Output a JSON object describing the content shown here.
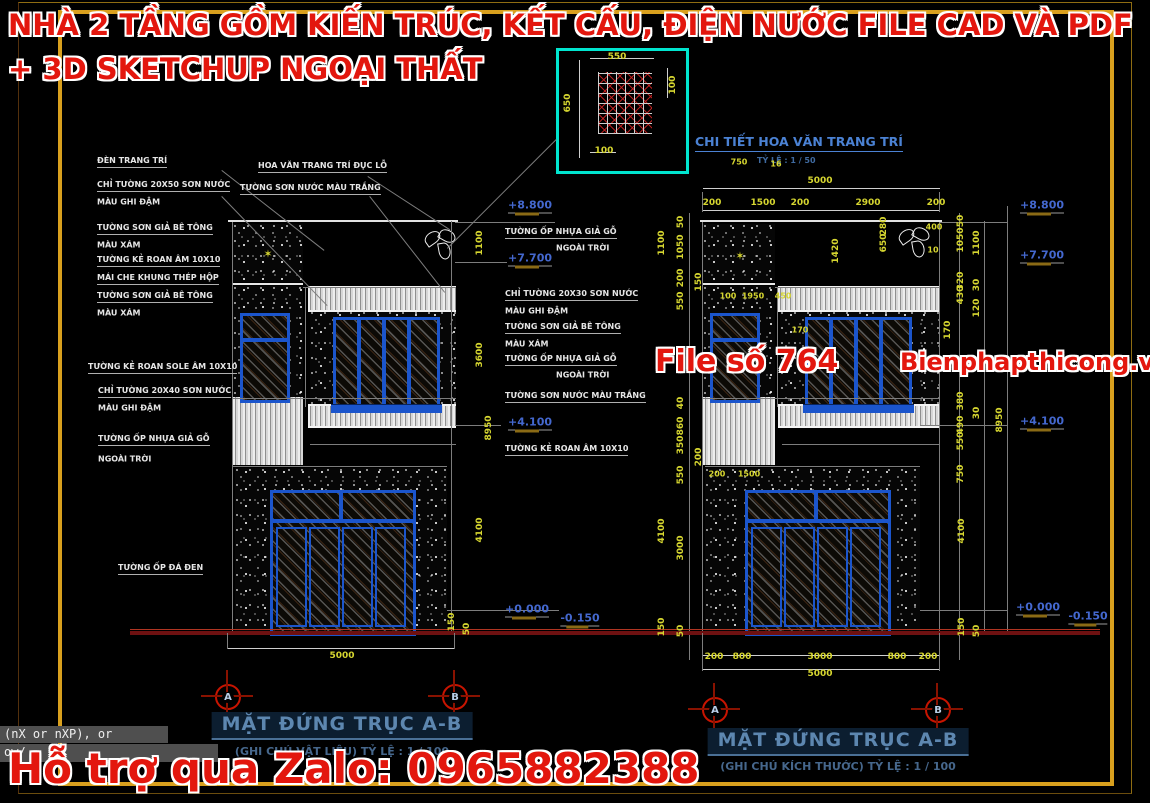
{
  "watermarks": {
    "top_line1": "NHÀ 2 TẦNG GỒM KIẾN TRÚC, KẾT CẤU, ĐIỆN NƯỚC FILE CAD VÀ PDF",
    "top_line2": "+ 3D SKETCHUP NGOẠI THẤT",
    "file_no": "File số 764",
    "site": "Bienphapthicong.vn",
    "bottom": "Hỗ trợ qua Zalo: 0965882388",
    "color": "#e3170e"
  },
  "detail_box": {
    "title": "CHI TIẾT HOA VĂN TRANG TRÍ",
    "scale": "TỶ LỆ : 1 / 50",
    "border_color": "#00e5cf"
  },
  "left_elevation": {
    "title": "MẶT ĐỨNG TRỤC A-B",
    "subtitle": "(GHI CHÚ VẬT LIỆU) TỶ LỆ : 1 / 100",
    "grid_axes": [
      "A",
      "B"
    ],
    "bottom_total_dim": "5000"
  },
  "right_elevation": {
    "title": "MẶT ĐỨNG TRỤC A-B",
    "subtitle": "(GHI CHÚ KÍCH THƯỚC) TỶ LỆ : 1 / 100",
    "grid_axes": [
      "A",
      "B"
    ],
    "top_total_dim": "5000",
    "top_chain_dims": [
      "200",
      "1500",
      "200",
      "2900",
      "200"
    ],
    "bottom_chain_dims": [
      "200",
      "800",
      "3000",
      "800",
      "200"
    ],
    "bottom_total_dim": "5000"
  },
  "levels": [
    "+8.800",
    "+7.700",
    "+4.100",
    "+0.000",
    "-0.150"
  ],
  "command_line": {
    "line1": "(nX or nXP), or",
    "line2": "ow/"
  },
  "colors": {
    "frame_orange": "#d9a01e",
    "dim_yellow": "#d6d630",
    "level_blue": "#4468cf",
    "cad_blue": "#1b55cc",
    "detail_cyan": "#00e5cf",
    "grid_bubble_red": "#c81400",
    "ground_red": "#6e1111",
    "title_blue": "#5d87b0",
    "watermark_red": "#e3170e"
  },
  "grid_bubbles": [
    {
      "letter": "A",
      "x": 228,
      "y": 697
    },
    {
      "letter": "B",
      "x": 455,
      "y": 697
    },
    {
      "letter": "A",
      "x": 715,
      "y": 710
    },
    {
      "letter": "B",
      "x": 938,
      "y": 710
    }
  ],
  "annotations": [
    {
      "t": "ĐÈN TRANG TRÍ",
      "x": 97,
      "y": 162,
      "c": "lblu"
    },
    {
      "t": "CHỈ TƯỜNG 20X50 SƠN NƯỚC",
      "x": 97,
      "y": 186,
      "c": "lblu"
    },
    {
      "t": "MÀU GHI ĐẬM",
      "x": 97,
      "y": 202,
      "c": "lbl"
    },
    {
      "t": "TƯỜNG SƠN GIẢ BÊ TÔNG",
      "x": 97,
      "y": 229,
      "c": "lblu"
    },
    {
      "t": "MÀU XÁM",
      "x": 97,
      "y": 245,
      "c": "lbl"
    },
    {
      "t": "TƯỜNG KẺ ROAN ÂM 10X10",
      "x": 97,
      "y": 261,
      "c": "lblu"
    },
    {
      "t": "MÁI CHE KHUNG THÉP HỘP",
      "x": 97,
      "y": 279,
      "c": "lblu"
    },
    {
      "t": "TƯỜNG SƠN GIẢ BÊ TÔNG",
      "x": 97,
      "y": 297,
      "c": "lblu"
    },
    {
      "t": "MÀU XÁM",
      "x": 97,
      "y": 313,
      "c": "lbl"
    },
    {
      "t": "TƯỜNG KẺ ROAN SOLE ÂM 10X10",
      "x": 88,
      "y": 368,
      "c": "lblu"
    },
    {
      "t": "CHỈ TƯỜNG 20X40 SƠN NƯỚC",
      "x": 98,
      "y": 392,
      "c": "lblu"
    },
    {
      "t": "MÀU GHI ĐẬM",
      "x": 98,
      "y": 408,
      "c": "lbl"
    },
    {
      "t": "TƯỜNG ỐP NHỰA GIẢ GỖ",
      "x": 98,
      "y": 440,
      "c": "lblu"
    },
    {
      "t": "NGOÀI TRỜI",
      "x": 98,
      "y": 459,
      "c": "lbl"
    },
    {
      "t": "TƯỜNG ỐP ĐÁ ĐEN",
      "x": 118,
      "y": 569,
      "c": "lblu"
    },
    {
      "t": "HOA VĂN TRANG TRÍ ĐỤC LỖ",
      "x": 258,
      "y": 167,
      "c": "lblu"
    },
    {
      "t": "TƯỜNG SƠN NƯỚC MÀU TRẮNG",
      "x": 240,
      "y": 189,
      "c": "lblu"
    },
    {
      "t": "TƯỜNG ỐP NHỰA GIẢ GỖ",
      "x": 505,
      "y": 233,
      "c": "lblu"
    },
    {
      "t": "NGOÀI TRỜI",
      "x": 556,
      "y": 248,
      "c": "lbl"
    },
    {
      "t": "CHỈ TƯỜNG 20X30 SƠN NƯỚC",
      "x": 505,
      "y": 295,
      "c": "lblu"
    },
    {
      "t": "MÀU GHI ĐẬM",
      "x": 505,
      "y": 311,
      "c": "lbl"
    },
    {
      "t": "TƯỜNG SƠN GIẢ BÊ TÔNG",
      "x": 505,
      "y": 328,
      "c": "lblu"
    },
    {
      "t": "MÀU XÁM",
      "x": 505,
      "y": 344,
      "c": "lbl"
    },
    {
      "t": "TƯỜNG ỐP NHỰA GIẢ GỖ",
      "x": 505,
      "y": 360,
      "c": "lblu"
    },
    {
      "t": "NGOÀI TRỜI",
      "x": 556,
      "y": 375,
      "c": "lbl"
    },
    {
      "t": "TƯỜNG SƠN NƯỚC MÀU TRẮNG",
      "x": 505,
      "y": 397,
      "c": "lblu"
    },
    {
      "t": "TƯỜNG KẺ ROAN ÂM 10X10",
      "x": 505,
      "y": 450,
      "c": "lblu"
    },
    {
      "t": "+8.800",
      "x": 530,
      "y": 206,
      "c": "lvl"
    },
    {
      "t": "+7.700",
      "x": 530,
      "y": 259,
      "c": "lvl"
    },
    {
      "t": "+4.100",
      "x": 530,
      "y": 423,
      "c": "lvl"
    },
    {
      "t": "+0.000",
      "x": 527,
      "y": 610,
      "c": "lvl"
    },
    {
      "t": "-0.150",
      "x": 580,
      "y": 619,
      "c": "lvl"
    },
    {
      "t": "+8.800",
      "x": 1042,
      "y": 206,
      "c": "lvl"
    },
    {
      "t": "+7.700",
      "x": 1042,
      "y": 256,
      "c": "lvl"
    },
    {
      "t": "+4.100",
      "x": 1042,
      "y": 422,
      "c": "lvl"
    },
    {
      "t": "+0.000",
      "x": 1038,
      "y": 608,
      "c": "lvl"
    },
    {
      "t": "-0.150",
      "x": 1088,
      "y": 617,
      "c": "lvl"
    },
    {
      "t": "1100",
      "x": 480,
      "y": 243,
      "c": "dimv"
    },
    {
      "t": "3600",
      "x": 480,
      "y": 355,
      "c": "dimv"
    },
    {
      "t": "8950",
      "x": 489,
      "y": 428,
      "c": "dimv"
    },
    {
      "t": "4100",
      "x": 480,
      "y": 530,
      "c": "dimv"
    },
    {
      "t": "150",
      "x": 452,
      "y": 622,
      "c": "dimv"
    },
    {
      "t": "50",
      "x": 467,
      "y": 629,
      "c": "dimv"
    },
    {
      "t": "5000",
      "x": 342,
      "y": 656,
      "c": "dim"
    },
    {
      "t": "550",
      "x": 617,
      "y": 57,
      "c": "dim"
    },
    {
      "t": "650",
      "x": 568,
      "y": 103,
      "c": "dimv"
    },
    {
      "t": "100",
      "x": 673,
      "y": 85,
      "c": "dimv"
    },
    {
      "t": "100",
      "x": 604,
      "y": 151,
      "c": "dim"
    },
    {
      "t": "5000",
      "x": 820,
      "y": 181,
      "c": "dim"
    },
    {
      "t": "200",
      "x": 712,
      "y": 203,
      "c": "dim"
    },
    {
      "t": "1500",
      "x": 763,
      "y": 203,
      "c": "dim"
    },
    {
      "t": "200",
      "x": 800,
      "y": 203,
      "c": "dim"
    },
    {
      "t": "2900",
      "x": 868,
      "y": 203,
      "c": "dim"
    },
    {
      "t": "200",
      "x": 936,
      "y": 203,
      "c": "dim"
    },
    {
      "t": "50",
      "x": 681,
      "y": 222,
      "c": "dimv"
    },
    {
      "t": "1050",
      "x": 681,
      "y": 247,
      "c": "dimv"
    },
    {
      "t": "1100",
      "x": 662,
      "y": 243,
      "c": "dimv"
    },
    {
      "t": "200",
      "x": 681,
      "y": 278,
      "c": "dimv"
    },
    {
      "t": "150",
      "x": 699,
      "y": 282,
      "c": "dimv"
    },
    {
      "t": "550",
      "x": 681,
      "y": 301,
      "c": "dimv"
    },
    {
      "t": "40",
      "x": 681,
      "y": 403,
      "c": "dimv"
    },
    {
      "t": "860",
      "x": 681,
      "y": 426,
      "c": "dimv"
    },
    {
      "t": "350",
      "x": 681,
      "y": 445,
      "c": "dimv"
    },
    {
      "t": "200",
      "x": 699,
      "y": 457,
      "c": "dimv"
    },
    {
      "t": "550",
      "x": 681,
      "y": 475,
      "c": "dimv"
    },
    {
      "t": "4100",
      "x": 662,
      "y": 531,
      "c": "dimv"
    },
    {
      "t": "3000",
      "x": 681,
      "y": 548,
      "c": "dimv"
    },
    {
      "t": "150",
      "x": 662,
      "y": 627,
      "c": "dimv"
    },
    {
      "t": "50",
      "x": 681,
      "y": 631,
      "c": "dimv"
    },
    {
      "t": "750",
      "x": 739,
      "y": 162,
      "c": "dims"
    },
    {
      "t": "16",
      "x": 776,
      "y": 164,
      "c": "dims"
    },
    {
      "t": "100",
      "x": 728,
      "y": 296,
      "c": "dims"
    },
    {
      "t": "1950",
      "x": 753,
      "y": 296,
      "c": "dims"
    },
    {
      "t": "450",
      "x": 783,
      "y": 296,
      "c": "dims"
    },
    {
      "t": "170",
      "x": 800,
      "y": 330,
      "c": "dims"
    },
    {
      "t": "1420",
      "x": 836,
      "y": 251,
      "c": "dimv"
    },
    {
      "t": "650",
      "x": 884,
      "y": 243,
      "c": "dimv"
    },
    {
      "t": "280",
      "x": 884,
      "y": 226,
      "c": "dimv"
    },
    {
      "t": "400",
      "x": 934,
      "y": 227,
      "c": "dims"
    },
    {
      "t": "10",
      "x": 933,
      "y": 250,
      "c": "dims"
    },
    {
      "t": "200",
      "x": 717,
      "y": 474,
      "c": "dims"
    },
    {
      "t": "1500",
      "x": 749,
      "y": 474,
      "c": "dims"
    },
    {
      "t": "50",
      "x": 961,
      "y": 221,
      "c": "dimv"
    },
    {
      "t": "1050",
      "x": 961,
      "y": 240,
      "c": "dimv"
    },
    {
      "t": "1100",
      "x": 977,
      "y": 243,
      "c": "dimv"
    },
    {
      "t": "320",
      "x": 961,
      "y": 281,
      "c": "dimv"
    },
    {
      "t": "430",
      "x": 961,
      "y": 295,
      "c": "dimv"
    },
    {
      "t": "30",
      "x": 977,
      "y": 285,
      "c": "dimv"
    },
    {
      "t": "120",
      "x": 977,
      "y": 308,
      "c": "dimv"
    },
    {
      "t": "170",
      "x": 948,
      "y": 330,
      "c": "dimv"
    },
    {
      "t": "380",
      "x": 961,
      "y": 401,
      "c": "dimv"
    },
    {
      "t": "30",
      "x": 977,
      "y": 413,
      "c": "dimv"
    },
    {
      "t": "490",
      "x": 961,
      "y": 425,
      "c": "dimv"
    },
    {
      "t": "8950",
      "x": 1000,
      "y": 420,
      "c": "dimv"
    },
    {
      "t": "550",
      "x": 961,
      "y": 441,
      "c": "dimv"
    },
    {
      "t": "750",
      "x": 961,
      "y": 474,
      "c": "dimv"
    },
    {
      "t": "4100",
      "x": 962,
      "y": 531,
      "c": "dimv"
    },
    {
      "t": "150",
      "x": 962,
      "y": 627,
      "c": "dimv"
    },
    {
      "t": "50",
      "x": 977,
      "y": 631,
      "c": "dimv"
    },
    {
      "t": "200",
      "x": 714,
      "y": 657,
      "c": "dim"
    },
    {
      "t": "800",
      "x": 742,
      "y": 657,
      "c": "dim"
    },
    {
      "t": "3000",
      "x": 820,
      "y": 657,
      "c": "dim"
    },
    {
      "t": "800",
      "x": 897,
      "y": 657,
      "c": "dim"
    },
    {
      "t": "200",
      "x": 928,
      "y": 657,
      "c": "dim"
    },
    {
      "t": "5000",
      "x": 820,
      "y": 674,
      "c": "dim"
    },
    {
      "t": "✶",
      "x": 268,
      "y": 254,
      "c": "dec"
    },
    {
      "t": "✶",
      "x": 740,
      "y": 256,
      "c": "dec"
    }
  ],
  "lines": [
    {
      "x": 228,
      "y": 220,
      "len": 230,
      "ang": 0,
      "col": "w"
    },
    {
      "x": 700,
      "y": 220,
      "len": 242,
      "ang": 0,
      "col": "w"
    },
    {
      "x": 228,
      "y": 648,
      "len": 227,
      "ang": 0,
      "col": "d"
    },
    {
      "x": 703,
      "y": 655,
      "len": 237,
      "ang": 0,
      "col": "d"
    },
    {
      "x": 703,
      "y": 669,
      "len": 237,
      "ang": 0,
      "col": "d"
    },
    {
      "x": 703,
      "y": 188,
      "len": 237,
      "ang": 0,
      "col": "d"
    },
    {
      "x": 703,
      "y": 210,
      "len": 237,
      "ang": 0,
      "col": "d"
    },
    {
      "x": 452,
      "y": 221,
      "len": 411,
      "ang": 90,
      "col": "g"
    },
    {
      "x": 690,
      "y": 213,
      "len": 447,
      "ang": 90,
      "col": "g"
    },
    {
      "x": 960,
      "y": 213,
      "len": 447,
      "ang": 90,
      "col": "g"
    },
    {
      "x": 985,
      "y": 221,
      "len": 411,
      "ang": 90,
      "col": "g"
    },
    {
      "x": 1008,
      "y": 206,
      "len": 426,
      "ang": 90,
      "col": "g"
    },
    {
      "x": 233,
      "y": 222,
      "len": 410,
      "ang": 90,
      "col": "g"
    },
    {
      "x": 703,
      "y": 222,
      "len": 410,
      "ang": 90,
      "col": "g"
    },
    {
      "x": 940,
      "y": 222,
      "len": 410,
      "ang": 90,
      "col": "g"
    },
    {
      "x": 306,
      "y": 287,
      "len": 120,
      "ang": 90,
      "col": "g"
    },
    {
      "x": 778,
      "y": 287,
      "len": 120,
      "ang": 90,
      "col": "g"
    },
    {
      "x": 303,
      "y": 287,
      "len": 153,
      "ang": 0,
      "col": "g"
    },
    {
      "x": 233,
      "y": 398,
      "len": 223,
      "ang": 0,
      "col": "g"
    },
    {
      "x": 310,
      "y": 444,
      "len": 146,
      "ang": 0,
      "col": "g"
    },
    {
      "x": 233,
      "y": 466,
      "len": 214,
      "ang": 0,
      "col": "g"
    },
    {
      "x": 775,
      "y": 287,
      "len": 165,
      "ang": 0,
      "col": "g"
    },
    {
      "x": 703,
      "y": 398,
      "len": 237,
      "ang": 0,
      "col": "g"
    },
    {
      "x": 782,
      "y": 444,
      "len": 158,
      "ang": 0,
      "col": "g"
    },
    {
      "x": 705,
      "y": 466,
      "len": 215,
      "ang": 0,
      "col": "g"
    },
    {
      "x": 455,
      "y": 222,
      "len": 100,
      "ang": 0,
      "col": "g"
    },
    {
      "x": 455,
      "y": 262,
      "len": 52,
      "ang": 0,
      "col": "g"
    },
    {
      "x": 455,
      "y": 425,
      "len": 46,
      "ang": 0,
      "col": "g"
    },
    {
      "x": 447,
      "y": 610,
      "len": 112,
      "ang": 0,
      "col": "g"
    },
    {
      "x": 940,
      "y": 222,
      "len": 68,
      "ang": 0,
      "col": "g"
    },
    {
      "x": 920,
      "y": 425,
      "len": 88,
      "ang": 0,
      "col": "g"
    },
    {
      "x": 920,
      "y": 610,
      "len": 88,
      "ang": 0,
      "col": "g"
    },
    {
      "x": 130,
      "y": 631,
      "len": 970,
      "ang": 0,
      "col": "r"
    },
    {
      "x": 130,
      "y": 629,
      "len": 970,
      "ang": 0,
      "col": "r2"
    },
    {
      "x": 222,
      "y": 170,
      "len": 130,
      "ang": 38,
      "col": "g"
    },
    {
      "x": 368,
      "y": 176,
      "len": 98,
      "ang": 33,
      "col": "g"
    },
    {
      "x": 370,
      "y": 196,
      "len": 122,
      "ang": 52,
      "col": "g"
    },
    {
      "x": 222,
      "y": 196,
      "len": 152,
      "ang": 46,
      "col": "g"
    },
    {
      "x": 447,
      "y": 248,
      "len": 154,
      "ang": -45,
      "col": "g"
    },
    {
      "x": 580,
      "y": 60,
      "len": 98,
      "ang": 90,
      "col": "d"
    },
    {
      "x": 590,
      "y": 58,
      "len": 64,
      "ang": 0,
      "col": "d"
    },
    {
      "x": 668,
      "y": 68,
      "len": 30,
      "ang": 90,
      "col": "d"
    },
    {
      "x": 590,
      "y": 152,
      "len": 26,
      "ang": 0,
      "col": "d"
    },
    {
      "x": 228,
      "y": 633,
      "len": 16,
      "ang": 90,
      "col": "g"
    },
    {
      "x": 455,
      "y": 633,
      "len": 16,
      "ang": 90,
      "col": "g"
    },
    {
      "x": 703,
      "y": 633,
      "len": 38,
      "ang": 90,
      "col": "g"
    },
    {
      "x": 940,
      "y": 633,
      "len": 38,
      "ang": 90,
      "col": "g"
    },
    {
      "x": 703,
      "y": 192,
      "len": 20,
      "ang": 90,
      "col": "g"
    },
    {
      "x": 940,
      "y": 192,
      "len": 20,
      "ang": 90,
      "col": "g"
    }
  ]
}
